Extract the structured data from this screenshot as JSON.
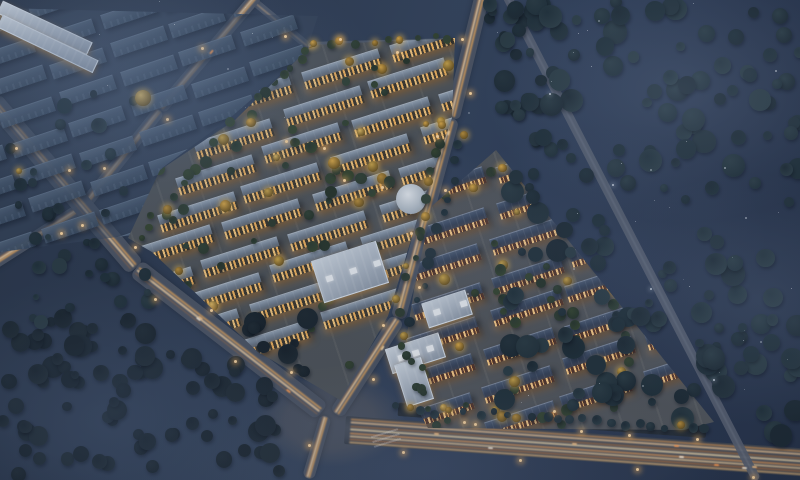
{
  "meta": {
    "description": "Aerial night-time architectural rendering of a large residential development: two illuminated low-rise housing estates, an unlit ghosted building phase at top-left, surrounding dark forests, and glowing roads with light trails converging on a highway interchange at the bottom.",
    "time_of_day": "night",
    "view": "aerial oblique"
  },
  "palette": {
    "css": {
      "bg-a": "#2a3649",
      "bg-b": "#35445c",
      "bg-c": "#273349",
      "dark-b1": "#56687e",
      "dark-b2": "#394a5f",
      "roofL-a": "#95a3b3",
      "roofL-b": "#4d5d72",
      "winL": "#f7c87e",
      "winL2": "#f2b45f",
      "roofR-a": "#4c5b73",
      "roofR-b": "#2a3750",
      "winR": "#ffd08a",
      "white-a": "#cfd8e2",
      "white-b": "#8c98a8",
      "road": "#4d5564",
      "road-dark": "#596171",
      "hwy-a": "#3c434e",
      "hwy-b": "#4a515d",
      "lamp": "#ffd9a2",
      "lamp-glow": "rgba(255,185,95,.75)",
      "median": "#262e37",
      "estateL-g": "#50555a",
      "estateR-g": "#53575c",
      "darkzone-g": "rgba(58,72,94,.55)",
      "junction": "#4e5563"
    },
    "trees": {
      "forest": [
        "#1d2a33",
        "#24333c",
        "#2b3c44",
        "#203039"
      ],
      "forestDeep": [
        "#18222a",
        "#1f2a32",
        "#1c2730"
      ],
      "estate": [
        "#2e3c31",
        "#35452f",
        "#27352b",
        "#314236"
      ],
      "lit": [
        "#c9a44a",
        "#daa948",
        "#b98f3c",
        "#e0ba62"
      ]
    },
    "stripes": {
      "avenue": [
        [
          34,
          "#e8a95e",
          2,
          0.85
        ],
        [
          52,
          "#ffd9a6",
          2,
          0.9
        ],
        [
          68,
          "#b97a44",
          1.3,
          0.6
        ]
      ],
      "path": [
        [
          46,
          "#eec089",
          1.5,
          0.75
        ]
      ],
      "dark": [
        [
          48,
          "#aeb6c4",
          1,
          0.3
        ]
      ],
      "highway": [
        [
          8,
          "#c98f55",
          2,
          0.8
        ],
        [
          19,
          "#f0c796",
          2,
          0.85
        ],
        [
          31,
          "#a86f3f",
          2,
          0.7
        ],
        [
          44,
          "#ffe3b0",
          1.5,
          0.8
        ],
        [
          56,
          "#d89558",
          2,
          0.85
        ],
        [
          68,
          "#f3cf9b",
          2,
          0.8
        ],
        [
          80,
          "#b87643",
          2,
          0.7
        ],
        [
          91,
          "#e8b87a",
          1.5,
          0.75
        ]
      ],
      "median": []
    },
    "cars": [
      "#ffdda6",
      "#fff3df",
      "#ff9e55",
      "#ffc98a"
    ]
  },
  "layers": {
    "roads": [
      {
        "name": "estate-north-access-road",
        "style": "path",
        "w": 8,
        "pts": [
          [
            245,
            -6
          ],
          [
            308,
            46
          ],
          [
            452,
            42
          ]
        ],
        "lamps": 3,
        "cars": 0
      },
      {
        "name": "northwest-boundary-road",
        "style": "avenue",
        "w": 12,
        "pts": [
          [
            258,
            -6
          ],
          [
            160,
            110
          ],
          [
            83,
            207
          ],
          [
            -10,
            266
          ]
        ],
        "lamps": 4,
        "cars": 1
      },
      {
        "name": "west-main-avenue",
        "style": "avenue",
        "w": 20,
        "pts": [
          [
            -8,
            100
          ],
          [
            136,
            268
          ],
          [
            322,
            412
          ]
        ],
        "lamps": 8,
        "cars": 3
      },
      {
        "name": "central-avenue",
        "style": "avenue",
        "w": 15,
        "pts": [
          [
            483,
            -8
          ],
          [
            452,
            118
          ],
          [
            398,
            318
          ],
          [
            336,
            414
          ]
        ],
        "lamps": 8,
        "cars": 2
      },
      {
        "name": "south-exit-road",
        "style": "avenue",
        "w": 12,
        "pts": [
          [
            326,
            416
          ],
          [
            308,
            478
          ]
        ],
        "lamps": 1,
        "cars": 0
      },
      {
        "name": "bottom-highway",
        "style": "highway",
        "w": 28,
        "pts": [
          [
            345,
            430
          ],
          [
            812,
            463
          ]
        ],
        "lamps": 7,
        "cars": 8
      },
      {
        "name": "highway-median",
        "style": "median",
        "w": 13,
        "pts": [
          [
            398,
            408
          ],
          [
            706,
            430
          ]
        ],
        "lamps": 3,
        "cars": 0
      },
      {
        "name": "east-overpass-road",
        "style": "dark",
        "w": 9,
        "pts": [
          [
            505,
            -8
          ],
          [
            757,
            480
          ]
        ],
        "lamps": 4,
        "dim": true,
        "cars": 0
      },
      {
        "name": "estate-spine-street",
        "style": "path",
        "w": 9,
        "pts": [
          [
            260,
            114
          ],
          [
            406,
            212
          ]
        ],
        "lamps": 4,
        "cars": 0
      }
    ],
    "clusters": [
      {
        "name": "cluster-unlit",
        "id": "cluster-unlit",
        "style": "dark",
        "clip": [
          [
            0,
            8
          ],
          [
            318,
            16
          ],
          [
            306,
            52
          ],
          [
            230,
            118
          ],
          [
            162,
            168
          ],
          [
            133,
            235
          ],
          [
            0,
            252
          ]
        ],
        "lattice": {
          "ox": -180,
          "oy": -30,
          "colx": 60,
          "coly": -20,
          "rowx": 10,
          "rowy": 29,
          "rows": 12,
          "c0": 0,
          "c1": 6,
          "bw": 56,
          "bh": 14,
          "rot": -18.4,
          "jitter": 2
        }
      },
      {
        "name": "estate-west",
        "id": "estate-west",
        "style": "left",
        "clip": [
          [
            312,
            45
          ],
          [
            455,
            38
          ],
          [
            452,
            118
          ],
          [
            420,
            210
          ],
          [
            388,
            316
          ],
          [
            340,
            400
          ],
          [
            258,
            352
          ],
          [
            152,
            252
          ],
          [
            128,
            238
          ],
          [
            160,
            170
          ],
          [
            235,
            120
          ]
        ],
        "lattice": {
          "ox": 303,
          "oy": 62,
          "colx": 88,
          "coly": -28,
          "rowx": -20,
          "rowy": 37,
          "rows": 9,
          "c0": -1,
          "c1": 3,
          "bw": 80,
          "bh": 18,
          "rot": -17.6,
          "jitter": 3
        },
        "trees": {
          "rect": [
            140,
            40,
            330,
            330
          ],
          "count": 85,
          "rMin": 3,
          "rMax": 6,
          "pal": "estate",
          "litChance": 0.32,
          "seed": 11
        }
      },
      {
        "name": "estate-east",
        "id": "estate-east",
        "style": "right",
        "clip": [
          [
            496,
            150
          ],
          [
            714,
            422
          ],
          [
            682,
            430
          ],
          [
            428,
            428
          ],
          [
            400,
            378
          ],
          [
            414,
            290
          ],
          [
            432,
            206
          ]
        ],
        "lattice": {
          "ox": 416,
          "oy": 180,
          "colx": 80,
          "coly": -26,
          "rowx": -2,
          "rowy": 37,
          "rows": 8,
          "c0": 0,
          "c1": 3,
          "bw": 72,
          "bh": 17,
          "rot": -18,
          "jitter": 3
        },
        "trees": {
          "rect": [
            396,
            150,
            330,
            290
          ],
          "count": 78,
          "rMin": 3,
          "rMax": 6,
          "pal": "estate",
          "litChance": 0.32,
          "seed": 12
        }
      }
    ],
    "landmarks": [
      {
        "name": "community-clubhouse-roof",
        "kind": "rect",
        "x": 316,
        "y": 250,
        "w": 66,
        "h": 42,
        "rot": -17.6,
        "skylights": 3
      },
      {
        "name": "retail-canopy-strip-1",
        "kind": "seg",
        "x1": 266,
        "y1": 120,
        "x2": 354,
        "y2": 161,
        "w": 12
      },
      {
        "name": "retail-canopy-strip-2",
        "kind": "seg",
        "x1": 316,
        "y1": 160,
        "x2": 410,
        "y2": 205,
        "w": 12
      },
      {
        "name": "round-pavilion",
        "kind": "dome",
        "x": 396,
        "y": 184,
        "d": 30
      },
      {
        "name": "l-shaped-school-building",
        "kind": "lshape",
        "x": 390,
        "y": 332,
        "rot": -17.6
      },
      {
        "name": "white-slab-building",
        "kind": "rect",
        "x": 424,
        "y": 296,
        "w": 44,
        "h": 24,
        "rot": -17.6,
        "skylights": 2
      }
    ],
    "treeRegions": [
      {
        "name": "boundary-tree-strip",
        "along": [
          306,
          52,
          140,
          232
        ],
        "jitter": 7,
        "count": 20,
        "rMin": 3,
        "rMax": 6,
        "pal": "estate",
        "litChance": 0.15,
        "seed": 21
      },
      {
        "name": "estate-top-tree-strip",
        "along": [
          312,
          46,
          450,
          40
        ],
        "jitter": 5,
        "count": 10,
        "rMin": 3,
        "rMax": 5,
        "pal": "estate",
        "litChance": 0.4,
        "seed": 22
      },
      {
        "name": "avenue-west-tree-strip",
        "along": [
          447,
          130,
          396,
          310
        ],
        "jitter": 6,
        "count": 14,
        "rMin": 3,
        "rMax": 5,
        "pal": "estate",
        "litChance": 0.45,
        "seed": 23
      },
      {
        "name": "avenue-east-tree-strip",
        "along": [
          466,
          130,
          412,
          318
        ],
        "jitter": 5,
        "count": 12,
        "rMin": 3,
        "rMax": 6,
        "pal": "forest",
        "litChance": 0.1,
        "seed": 24
      },
      {
        "name": "forest-top-gap",
        "rect": [
          486,
          0,
          70,
          120
        ],
        "count": 26,
        "rMin": 4,
        "rMax": 9,
        "pal": "forest",
        "litChance": 0,
        "seed": 25
      },
      {
        "name": "forest-east",
        "rect": [
          500,
          0,
          300,
          436
        ],
        "count": 190,
        "rMin": 4,
        "rMax": 12,
        "pal": "forest",
        "litChance": 0,
        "seed": 26,
        "avoid": [
          [
            505,
            -8,
            757,
            480,
            8
          ],
          [
            345,
            430,
            812,
            463,
            17
          ],
          [
            398,
            408,
            706,
            430,
            9
          ]
        ]
      },
      {
        "name": "forest-bottom-left",
        "rect": [
          0,
          318,
          308,
          160
        ],
        "count": 105,
        "rMin": 4,
        "rMax": 11,
        "pal": "forestDeep",
        "litChance": 0,
        "seed": 27,
        "avoid": [
          [
            136,
            268,
            322,
            412,
            12
          ],
          [
            326,
            416,
            308,
            478,
            10
          ],
          [
            300,
            418,
            360,
            446,
            22
          ]
        ]
      },
      {
        "name": "west-edge-trees",
        "rect": [
          0,
          86,
          150,
          240
        ],
        "count": 50,
        "rMin": 3,
        "rMax": 8,
        "pal": "forest",
        "litChance": 0.12,
        "seed": 28,
        "avoid": [
          [
            -8,
            100,
            136,
            268,
            11
          ],
          [
            258,
            -6,
            83,
            207,
            8
          ]
        ]
      },
      {
        "name": "highway-median-trees",
        "along": [
          398,
          408,
          706,
          430
        ],
        "jitter": 4,
        "count": 24,
        "rMin": 3,
        "rMax": 5,
        "pal": "forest",
        "litChance": 0.12,
        "seed": 29
      },
      {
        "name": "school-plot-trees",
        "along": [
          398,
          330,
          440,
          420
        ],
        "jitter": 8,
        "count": 10,
        "rMin": 3,
        "rMax": 5,
        "pal": "estate",
        "litChance": 0.3,
        "seed": 30
      }
    ],
    "fog": [
      [
        300,
        200,
        90,
        55,
        "rgba(115,135,165,0.20)"
      ],
      [
        320,
        220,
        160,
        95,
        "rgba(110,132,165,0.26)"
      ],
      [
        280,
        190,
        680,
        90,
        "rgba(148,168,198,0.22)"
      ],
      [
        260,
        180,
        760,
        300,
        "rgba(140,160,190,0.18)"
      ],
      [
        300,
        210,
        110,
        420,
        "rgba(95,115,145,0.26)"
      ],
      [
        420,
        160,
        430,
        470,
        "rgba(125,135,155,0.16)"
      ],
      [
        240,
        160,
        600,
        240,
        "rgba(120,140,170,0.12)"
      ],
      [
        200,
        150,
        420,
        250,
        "rgba(150,170,200,0.07)"
      ]
    ],
    "specks": [
      {
        "rect": [
          460,
          0,
          340,
          440
        ],
        "count": 38,
        "seed": 31
      },
      {
        "rect": [
          30,
          0,
          280,
          130
        ],
        "count": 10,
        "seed": 32
      }
    ],
    "junction": {
      "x": 255,
      "y": 372,
      "w": 150,
      "h": 95
    },
    "zebra": {
      "x": 380,
      "y": 424,
      "w": 12,
      "h": 28,
      "rot": 73
    }
  }
}
